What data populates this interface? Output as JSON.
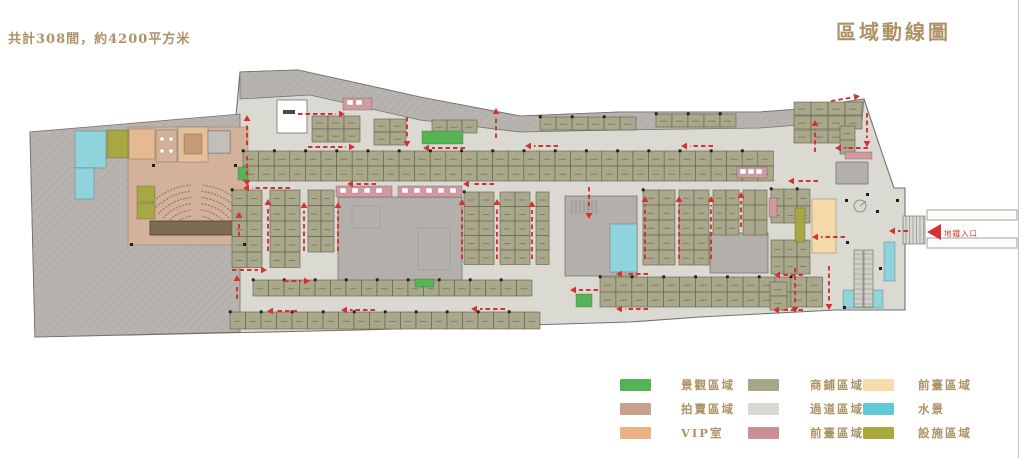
{
  "header": {
    "note": "共計308間，約4200平方米",
    "title": "區域動線圖"
  },
  "entrance": {
    "label": "地鐵入口"
  },
  "colors": {
    "base": "#dbdad2",
    "outline": "#72726b",
    "gray": "#b7b4b0",
    "hatch": "#a19e9a",
    "core": "#b3b0ac",
    "core_stroke": "#76766f",
    "shop": "#a9a88b",
    "shop_stroke": "#5f5e4e",
    "tan": "#d4b19b",
    "stage": "#7e6b56",
    "seat": "#93806d",
    "vip": "#e6ba90",
    "conf": "#e3c09a",
    "table": "#c69c78",
    "facility": "#a7a743",
    "pink": "#cf9aa0",
    "peach": "#f6d9a8",
    "water": "#8fd4dc",
    "green": "#55b455",
    "red": "#d63030",
    "grayroom": "#c2bfbb",
    "white": "#ffffff"
  },
  "legend": {
    "items": [
      {
        "color": "#54b354",
        "label": "景觀區域"
      },
      {
        "color": "#c7a18b",
        "label": "拍賣區域"
      },
      {
        "color": "#e8b283",
        "label": "VIP室"
      },
      {
        "color": "#a7a68a",
        "label": "商鋪區域"
      },
      {
        "color": "#d9d9d1",
        "label": "過道區域"
      },
      {
        "color": "#c98f93",
        "label": "前臺區域"
      },
      {
        "color": "#f8dcab",
        "label": "前臺區域"
      },
      {
        "color": "#62c9da",
        "label": "水景"
      },
      {
        "color": "#a9a93e",
        "label": "設施區域"
      }
    ],
    "col_x": [
      0,
      128,
      243
    ],
    "label_dx": [
      61,
      62,
      55
    ],
    "row_y": [
      2,
      26,
      50
    ]
  },
  "plan": {
    "footprint": [
      [
        30,
        132
      ],
      [
        236,
        116
      ],
      [
        240,
        72
      ],
      [
        298,
        70
      ],
      [
        420,
        97
      ],
      [
        520,
        116
      ],
      [
        620,
        112
      ],
      [
        760,
        112
      ],
      [
        800,
        109
      ],
      [
        864,
        99
      ],
      [
        880,
        147
      ],
      [
        894,
        188
      ],
      [
        905,
        188
      ],
      [
        905,
        310
      ],
      [
        836,
        310
      ],
      [
        700,
        317
      ],
      [
        630,
        322
      ],
      [
        360,
        330
      ],
      [
        35,
        337
      ]
    ],
    "left_wing": [
      [
        30,
        132
      ],
      [
        240,
        114
      ],
      [
        240,
        332
      ],
      [
        35,
        337
      ]
    ],
    "top_band": [
      [
        240,
        72
      ],
      [
        298,
        70
      ],
      [
        420,
        97
      ],
      [
        520,
        116
      ],
      [
        620,
        112
      ],
      [
        760,
        112
      ],
      [
        800,
        109
      ],
      [
        864,
        99
      ],
      [
        862,
        120
      ],
      [
        760,
        128
      ],
      [
        620,
        130
      ],
      [
        520,
        132
      ],
      [
        420,
        120
      ],
      [
        310,
        95
      ],
      [
        240,
        99
      ]
    ],
    "void_rect": [
      277,
      100,
      30,
      33
    ],
    "cores": [
      [
        338,
        197,
        124,
        85
      ],
      [
        565,
        196,
        72,
        80
      ],
      [
        710,
        233,
        58,
        40
      ],
      [
        836,
        162,
        32,
        22
      ],
      [
        208,
        131,
        22,
        22
      ]
    ],
    "core_inner": [
      [
        352,
        206,
        28,
        22
      ],
      [
        418,
        228,
        32,
        42
      ]
    ],
    "treads": {
      "x0": 572,
      "x1": 598,
      "step": 4,
      "y0": 200,
      "y1": 214
    },
    "auction": {
      "zone": [
        128,
        127,
        120,
        118
      ],
      "stage": [
        150,
        221,
        92,
        14
      ],
      "seats": {
        "cx": 196,
        "cy": 248,
        "r0": 26,
        "dr": 6.2,
        "n": 7,
        "a1": 222,
        "a2": 318
      },
      "aisle": [
        191,
        184,
        10,
        37
      ]
    },
    "grids": [
      {
        "x": 312,
        "y": 116,
        "uw": 16,
        "uh": 13,
        "cols": 3,
        "rows": 2
      },
      {
        "x": 374,
        "y": 119,
        "uw": 16,
        "uh": 13,
        "cols": 2,
        "rows": 2
      },
      {
        "x": 432,
        "y": 120,
        "uw": 15,
        "uh": 13,
        "cols": 3,
        "rows": 1
      },
      {
        "x": 540,
        "y": 117,
        "uw": 16,
        "uh": 13,
        "cols": 6,
        "rows": 1,
        "dots": true
      },
      {
        "x": 656,
        "y": 114,
        "uw": 16,
        "uh": 13,
        "cols": 5,
        "rows": 1,
        "dots": true
      },
      {
        "x": 794,
        "y": 102,
        "uw": 17,
        "uh": 13,
        "cols": 4,
        "rows": 1
      },
      {
        "x": 794,
        "y": 116,
        "uw": 17,
        "uh": 13,
        "cols": 4,
        "rows": 1
      },
      {
        "x": 794,
        "y": 130,
        "uw": 17,
        "uh": 13,
        "cols": 3,
        "rows": 1
      },
      {
        "x": 840,
        "y": 126,
        "uw": 15,
        "uh": 14,
        "cols": 1,
        "rows": 2
      },
      {
        "x": 243,
        "y": 151,
        "uw": 15.6,
        "uh": 15,
        "cols": 34,
        "rows": 2,
        "dots": true
      },
      {
        "x": 232,
        "y": 190,
        "uw": 15,
        "uh": 15.5,
        "cols": 2,
        "rows": 5,
        "dots": true
      },
      {
        "x": 270,
        "y": 190,
        "uw": 15,
        "uh": 15.5,
        "cols": 2,
        "rows": 5
      },
      {
        "x": 308,
        "y": 190,
        "uw": 13,
        "uh": 15.5,
        "cols": 2,
        "rows": 4
      },
      {
        "x": 464,
        "y": 192,
        "uw": 15,
        "uh": 14.5,
        "cols": 2,
        "rows": 5,
        "dots": true
      },
      {
        "x": 500,
        "y": 192,
        "uw": 15,
        "uh": 14.5,
        "cols": 2,
        "rows": 5
      },
      {
        "x": 536,
        "y": 192,
        "uw": 13,
        "uh": 14.5,
        "cols": 1,
        "rows": 5
      },
      {
        "x": 643,
        "y": 190,
        "uw": 16,
        "uh": 15,
        "cols": 2,
        "rows": 5,
        "dots": true
      },
      {
        "x": 679,
        "y": 190,
        "uw": 15,
        "uh": 15,
        "cols": 2,
        "rows": 5
      },
      {
        "x": 713,
        "y": 190,
        "uw": 13,
        "uh": 15,
        "cols": 2,
        "rows": 3
      },
      {
        "x": 743,
        "y": 190,
        "uw": 12,
        "uh": 15,
        "cols": 2,
        "rows": 3
      },
      {
        "x": 771,
        "y": 189,
        "uw": 13,
        "uh": 17,
        "cols": 3,
        "rows": 2,
        "dots": true
      },
      {
        "x": 771,
        "y": 240,
        "uw": 13,
        "uh": 17,
        "cols": 3,
        "rows": 2
      },
      {
        "x": 253,
        "y": 280,
        "uw": 15.5,
        "uh": 16,
        "cols": 18,
        "rows": 1,
        "dots": true
      },
      {
        "x": 230,
        "y": 312,
        "uw": 15.5,
        "uh": 17,
        "cols": 20,
        "rows": 1,
        "dots": true
      },
      {
        "x": 600,
        "y": 277,
        "uw": 15.9,
        "uh": 15,
        "cols": 14,
        "rows": 2,
        "dots": true
      },
      {
        "x": 770,
        "y": 282,
        "uw": 17,
        "uh": 14,
        "cols": 1,
        "rows": 2
      }
    ],
    "patches": [
      {
        "r": [
          75,
          131,
          31,
          37
        ],
        "c": "water"
      },
      {
        "r": [
          75,
          168,
          19,
          31
        ],
        "c": "water"
      },
      {
        "r": [
          107,
          130,
          21,
          28
        ],
        "c": "facility"
      },
      {
        "r": [
          129,
          129,
          26,
          30
        ],
        "c": "vip"
      },
      {
        "r": [
          156,
          130,
          21,
          32
        ],
        "c": "tan"
      },
      {
        "r": [
          178,
          127,
          30,
          35
        ],
        "c": "conf"
      },
      {
        "r": [
          184,
          134,
          18,
          20
        ],
        "c": "table"
      },
      {
        "r": [
          208,
          131,
          22,
          22
        ],
        "c": "grayroom"
      },
      {
        "r": [
          137,
          186,
          18,
          16
        ],
        "c": "facility"
      },
      {
        "r": [
          137,
          203,
          18,
          16
        ],
        "c": "facility"
      },
      {
        "r": [
          238,
          167,
          10,
          13
        ],
        "c": "green"
      },
      {
        "r": [
          422,
          131,
          41,
          13
        ],
        "c": "green"
      },
      {
        "r": [
          415,
          279,
          19,
          8
        ],
        "c": "green"
      },
      {
        "r": [
          576,
          294,
          16,
          13
        ],
        "c": "green"
      },
      {
        "r": [
          336,
          186,
          56,
          11
        ],
        "c": "pink"
      },
      {
        "r": [
          398,
          186,
          64,
          11
        ],
        "c": "pink"
      },
      {
        "r": [
          343,
          98,
          29,
          12
        ],
        "c": "pink"
      },
      {
        "r": [
          737,
          167,
          30,
          11
        ],
        "c": "pink"
      },
      {
        "r": [
          845,
          152,
          27,
          7
        ],
        "c": "pink"
      },
      {
        "r": [
          769,
          198,
          8,
          19
        ],
        "c": "pink"
      },
      {
        "r": [
          812,
          199,
          24,
          54
        ],
        "c": "peach"
      },
      {
        "r": [
          795,
          208,
          10,
          34
        ],
        "c": "facility"
      },
      {
        "r": [
          610,
          224,
          27,
          48
        ],
        "c": "water"
      },
      {
        "r": [
          884,
          242,
          11,
          39
        ],
        "c": "water"
      },
      {
        "r": [
          843,
          290,
          40,
          18
        ],
        "c": "water"
      }
    ],
    "white_ticks": [
      [
        340,
        188
      ],
      [
        352,
        188
      ],
      [
        364,
        188
      ],
      [
        376,
        188
      ],
      [
        402,
        188
      ],
      [
        414,
        188
      ],
      [
        426,
        188
      ],
      [
        438,
        188
      ],
      [
        450,
        188
      ],
      [
        347,
        100
      ],
      [
        356,
        100
      ],
      [
        740,
        169
      ],
      [
        748,
        169
      ],
      [
        756,
        169
      ]
    ],
    "circles": [
      [
        162,
        139
      ],
      [
        171,
        139
      ],
      [
        162,
        151
      ],
      [
        171,
        151
      ]
    ],
    "escalators": [
      [
        854,
        250,
        9,
        57
      ],
      [
        864,
        250,
        9,
        57
      ]
    ],
    "stairs_hatch": [
      903,
      216,
      22,
      28
    ],
    "rails": [
      [
        927,
        210,
        90,
        10
      ],
      [
        927,
        238,
        90,
        10
      ]
    ],
    "spiral": [
      860,
      206
    ],
    "entry_triangle": [
      [
        941,
        224
      ],
      [
        941,
        240
      ],
      [
        927,
        232
      ]
    ],
    "entry_label_pos": [
      944,
      236
    ],
    "black_dots": [
      [
        152,
        164
      ],
      [
        234,
        164
      ],
      [
        130,
        243
      ],
      [
        243,
        243
      ],
      [
        845,
        199
      ],
      [
        876,
        210
      ],
      [
        846,
        241
      ],
      [
        879,
        267
      ],
      [
        843,
        306
      ],
      [
        866,
        193
      ],
      [
        896,
        199
      ]
    ],
    "void_mark": [
      283,
      110,
      12,
      4
    ],
    "arrows": [
      [
        298,
        114,
        340,
        114
      ],
      [
        308,
        147,
        350,
        147
      ],
      [
        465,
        148,
        428,
        148
      ],
      [
        376,
        184,
        352,
        184
      ],
      [
        494,
        184,
        468,
        184
      ],
      [
        290,
        188,
        248,
        188
      ],
      [
        558,
        146,
        530,
        146
      ],
      [
        713,
        146,
        686,
        146
      ],
      [
        868,
        148,
        840,
        148
      ],
      [
        818,
        181,
        793,
        181
      ],
      [
        232,
        270,
        262,
        270
      ],
      [
        284,
        281,
        305,
        281
      ],
      [
        297,
        311,
        272,
        311
      ],
      [
        375,
        310,
        346,
        310
      ],
      [
        505,
        309,
        476,
        309
      ],
      [
        598,
        290,
        575,
        290
      ],
      [
        648,
        274,
        621,
        274
      ],
      [
        803,
        275,
        779,
        275
      ],
      [
        648,
        309,
        621,
        309
      ],
      [
        803,
        310,
        778,
        310
      ],
      [
        845,
        237,
        817,
        237
      ],
      [
        908,
        231,
        894,
        231
      ],
      [
        831,
        101,
        855,
        97
      ],
      [
        247,
        145,
        247,
        120
      ],
      [
        247,
        156,
        247,
        181
      ],
      [
        407,
        117,
        407,
        142
      ],
      [
        496,
        138,
        496,
        113
      ],
      [
        268,
        251,
        268,
        204
      ],
      [
        304,
        251,
        304,
        207
      ],
      [
        338,
        251,
        338,
        207
      ],
      [
        462,
        259,
        462,
        204
      ],
      [
        497,
        259,
        497,
        204
      ],
      [
        532,
        259,
        532,
        206
      ],
      [
        589,
        187,
        589,
        214
      ],
      [
        645,
        259,
        645,
        201
      ],
      [
        679,
        259,
        679,
        201
      ],
      [
        711,
        259,
        711,
        201
      ],
      [
        741,
        227,
        741,
        197
      ],
      [
        795,
        268,
        795,
        308
      ],
      [
        829,
        266,
        829,
        305
      ],
      [
        815,
        152,
        815,
        125
      ],
      [
        867,
        113,
        867,
        142
      ],
      [
        239,
        236,
        239,
        217
      ],
      [
        237,
        299,
        237,
        280
      ]
    ]
  }
}
